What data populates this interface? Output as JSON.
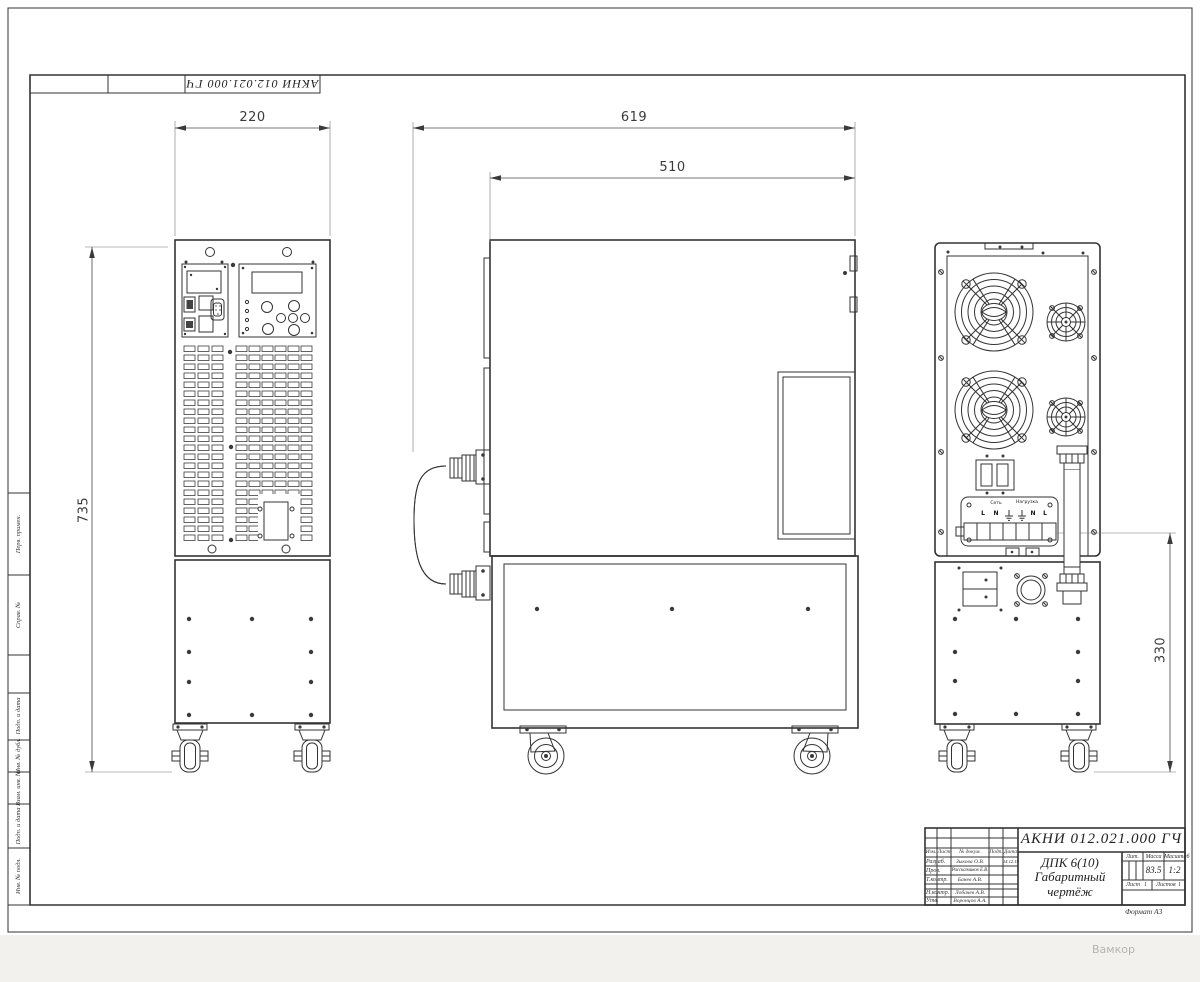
{
  "frame": {
    "top_designation": "АКНИ 012.021.000 ГЧ",
    "format_label": "Формат А3",
    "watermark": "Вамкор",
    "margin_stamps": [
      "Перв. примен.",
      "Справ. №",
      "Подп. и дата",
      "Инв. № дубл.",
      "Взам. инв. №",
      "Подп. и дата",
      "Инв. № подл."
    ]
  },
  "dims": {
    "front_width": "220",
    "overall_depth": "619",
    "body_depth": "510",
    "height": "735",
    "rear_section_height": "330"
  },
  "rear_panel": {
    "mains_label": "Сеть",
    "load_label": "Нагрузка",
    "terminals": [
      "L",
      "N",
      "⏚",
      "⏚",
      "N",
      "L"
    ]
  },
  "title_block": {
    "designation": "АКНИ 012.021.000 ГЧ",
    "product_name": "ДПК 6(10)",
    "doc_type_line1": "Габаритный",
    "doc_type_line2": "чертёж",
    "col_izm": "Изм.",
    "col_list": "Лист",
    "col_doc": "№ докум.",
    "col_podp": "Подп.",
    "col_data": "Дата",
    "lit_label": "Лит.",
    "mass_label": "Масса",
    "scale_label": "Масштаб",
    "mass_value": "83.5",
    "scale_value": "1:2",
    "sheet_label": "Лист",
    "sheet_value": "1",
    "sheets_label": "Листов",
    "sheets_value": "1",
    "rows": [
      {
        "role": "Разраб.",
        "name": "Зыкова О.В.",
        "date": "14.12.19"
      },
      {
        "role": "Пров.",
        "name": "Рассказчиков Е.В.",
        "date": ""
      },
      {
        "role": "Т.контр.",
        "name": "Банев А.В.",
        "date": ""
      },
      {
        "role": "Н.контр.",
        "name": "Лобачев А.В.",
        "date": ""
      },
      {
        "role": "Утв.",
        "name": "Воронцов А.А.",
        "date": ""
      }
    ]
  }
}
